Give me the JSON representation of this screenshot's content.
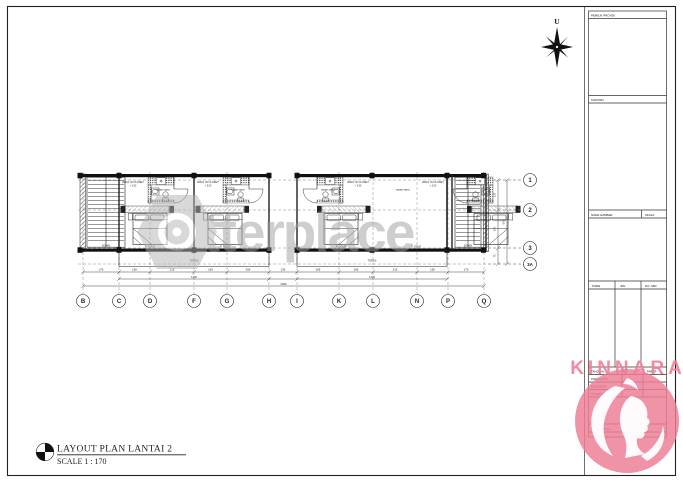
{
  "sheet": {
    "title": "LAYOUT PLAN  LANTAI 2",
    "scale": "SCALE 1 : 170"
  },
  "compass": {
    "north_label": "U"
  },
  "watermark": {
    "brand": "betterplace"
  },
  "brand": {
    "name": "KINNARA"
  },
  "grid": {
    "columns": [
      "B",
      "C",
      "D",
      "F",
      "G",
      "H",
      "I",
      "K",
      "L",
      "N",
      "P",
      "Q"
    ],
    "rows": [
      "1",
      "2",
      "3",
      "3A"
    ]
  },
  "dims": {
    "bottom": [
      "170",
      "150",
      "215",
      "160",
      "205",
      "135",
      "205",
      "165",
      "215",
      "150",
      "175"
    ],
    "subtotal_left": "1100",
    "subtotal_right": "1100",
    "total": "2080",
    "right": [
      "225",
      "300",
      "75"
    ],
    "right_total": "600"
  },
  "plan": {
    "stair_label": "DOWN",
    "closet_label": "WALK IN CLOSET",
    "level": "+ 3.50",
    "bath_label": "KAMAR MANDI",
    "bed_label": "R. TIDUR",
    "balcony_label": "TERAS"
  },
  "title_block": {
    "owner_label": "PEMILIK PROYEK",
    "notes_label": "CATATAN",
    "drawing_label": "NAMA GAMBAR",
    "scale_label": "SKALA",
    "code_label": "KODE",
    "qty_label": "JML",
    "sheet_label": "NO. LBR",
    "date_label": "TANGGAL",
    "sign_label": "PARAF",
    "consultant_label": "KONSULTAN",
    "consultant_value": "..........",
    "drawn_label": "DIGAMBAR",
    "drawn_value": "..........",
    "checked_label": "DIPERIKSA",
    "checked_value": "..........",
    "remark_label": "KETERANGAN"
  }
}
